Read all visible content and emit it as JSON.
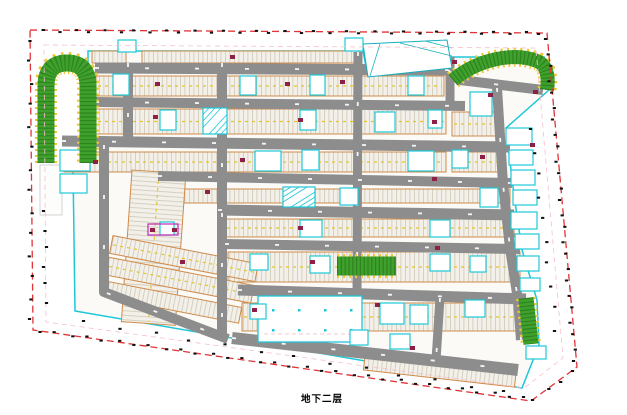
{
  "title": {
    "floor_label": "地下二层"
  },
  "colors": {
    "boundary_red": "#e03438",
    "inner_pink": "#f5bfcb",
    "cad_cyan": "#1ec7d8",
    "cad_teal": "#16b0bc",
    "road_gray": "#8d8d8d",
    "garage_fill": "#fbfaf7",
    "stall_fill": "#f2f0e8",
    "stall_line": "#c9c3b2",
    "row_border_orange": "#cf8a4a",
    "lane_yellow": "#e3c42c",
    "ramp_green": "#3ea12c",
    "ramp_hatch_green": "#2e7d1e",
    "ramp_tooth_yellow": "#edc832",
    "marker_maroon": "#8e1f45",
    "magenta": "#c028b8",
    "tick_black": "#111111",
    "label_black": "#000000"
  },
  "plan": {
    "canvas": [
      627,
      415
    ],
    "label_pos": [
      322,
      398
    ],
    "boundary_outer": [
      [
        30,
        30
      ],
      [
        547,
        33
      ],
      [
        577,
        367
      ],
      [
        531,
        401
      ],
      [
        33,
        330
      ]
    ],
    "boundary_inner": [
      [
        44,
        45
      ],
      [
        536,
        48
      ],
      [
        563,
        358
      ],
      [
        524,
        388
      ],
      [
        46,
        322
      ]
    ],
    "garage_outline": [
      [
        88,
        51
      ],
      [
        363,
        51
      ],
      [
        368,
        77
      ],
      [
        447,
        69
      ],
      [
        450,
        57
      ],
      [
        544,
        57
      ],
      [
        549,
        90
      ],
      [
        506,
        128
      ],
      [
        514,
        195
      ],
      [
        522,
        250
      ],
      [
        537,
        300
      ],
      [
        539,
        345
      ],
      [
        522,
        388
      ],
      [
        75,
        311
      ],
      [
        73,
        168
      ],
      [
        88,
        162
      ]
    ],
    "left_strip": [
      40,
      165,
      22,
      50
    ],
    "slope_area": {
      "points": [
        [
          363,
          44
        ],
        [
          447,
          40
        ],
        [
          452,
          68
        ],
        [
          368,
          77
        ]
      ],
      "lines": [
        [
          380,
          44,
          370,
          76
        ],
        [
          400,
          43,
          452,
          56
        ],
        [
          425,
          41,
          452,
          48
        ]
      ]
    },
    "parking_rows": [
      {
        "x": 142,
        "y": 51,
        "w": 216,
        "h": 12,
        "angle": 0,
        "cx": 0,
        "cy": 0,
        "orient": "h"
      },
      {
        "x": 92,
        "y": 51,
        "w": 34,
        "h": 12,
        "angle": 0,
        "cx": 0,
        "cy": 0,
        "orient": "h"
      },
      {
        "x": 96,
        "y": 76,
        "w": 348,
        "h": 20,
        "angle": 0,
        "cx": 0,
        "cy": 0,
        "orient": "h"
      },
      {
        "x": 96,
        "y": 109,
        "w": 350,
        "h": 25,
        "angle": 0,
        "cx": 0,
        "cy": 0,
        "orient": "h"
      },
      {
        "x": 452,
        "y": 112,
        "w": 50,
        "h": 24,
        "angle": 0,
        "cx": 0,
        "cy": 0,
        "orient": "h"
      },
      {
        "x": 64,
        "y": 152,
        "w": 382,
        "h": 20,
        "angle": 0,
        "cx": 0,
        "cy": 0,
        "orient": "h"
      },
      {
        "x": 452,
        "y": 152,
        "w": 52,
        "h": 20,
        "angle": 0,
        "cx": 0,
        "cy": 0,
        "orient": "h"
      },
      {
        "x": 160,
        "y": 189,
        "w": 350,
        "h": 14,
        "angle": 0,
        "cx": 0,
        "cy": 0,
        "orient": "h"
      },
      {
        "x": 218,
        "y": 219,
        "w": 296,
        "h": 18,
        "angle": 0,
        "cx": 0,
        "cy": 0,
        "orient": "h"
      },
      {
        "x": 228,
        "y": 252,
        "w": 292,
        "h": 30,
        "angle": 0,
        "cx": 0,
        "cy": 0,
        "orient": "h"
      },
      {
        "x": 242,
        "y": 303,
        "w": 282,
        "h": 28,
        "angle": 0,
        "cx": 0,
        "cy": 0,
        "orient": "h"
      },
      {
        "x": 132,
        "y": 170,
        "w": 54,
        "h": 152,
        "angle": 4,
        "cx": 132,
        "cy": 170,
        "orient": "v"
      },
      {
        "x": 112,
        "y": 234,
        "w": 148,
        "h": 18,
        "angle": 11,
        "cx": 104,
        "cy": 240,
        "orient": "h"
      },
      {
        "x": 112,
        "y": 256,
        "w": 148,
        "h": 18,
        "angle": 11,
        "cx": 104,
        "cy": 240,
        "orient": "h"
      },
      {
        "x": 116,
        "y": 280,
        "w": 136,
        "h": 16,
        "angle": 11,
        "cx": 104,
        "cy": 240,
        "orient": "h"
      },
      {
        "x": 365,
        "y": 356,
        "w": 152,
        "h": 14,
        "angle": 6.5,
        "cx": 365,
        "cy": 356,
        "orient": "h"
      }
    ],
    "roads": [
      {
        "pts": [
          [
            95,
            68
          ],
          [
            448,
            70
          ]
        ],
        "w": 11
      },
      {
        "pts": [
          [
            448,
            70
          ],
          [
            460,
            80
          ],
          [
            543,
            90
          ]
        ],
        "w": 10
      },
      {
        "pts": [
          [
            95,
            102
          ],
          [
            465,
            106
          ]
        ],
        "w": 10
      },
      {
        "pts": [
          [
            62,
            141
          ],
          [
            510,
            147
          ]
        ],
        "w": 11
      },
      {
        "pts": [
          [
            158,
            176
          ],
          [
            512,
            183
          ]
        ],
        "w": 10
      },
      {
        "pts": [
          [
            218,
            210
          ],
          [
            514,
            215
          ]
        ],
        "w": 11
      },
      {
        "pts": [
          [
            225,
            244
          ],
          [
            520,
            249
          ]
        ],
        "w": 10
      },
      {
        "pts": [
          [
            238,
            290
          ],
          [
            526,
            299
          ]
        ],
        "w": 11
      },
      {
        "pts": [
          [
            232,
            338
          ],
          [
            518,
            370
          ]
        ],
        "w": 12
      },
      {
        "pts": [
          [
            128,
            63
          ],
          [
            128,
            145
          ]
        ],
        "w": 10
      },
      {
        "pts": [
          [
            104,
            145
          ],
          [
            104,
            292
          ],
          [
            228,
            339
          ]
        ],
        "w": 10
      },
      {
        "pts": [
          [
            222,
            63
          ],
          [
            222,
            338
          ]
        ],
        "w": 10
      },
      {
        "pts": [
          [
            358,
            52
          ],
          [
            357,
            298
          ]
        ],
        "w": 9
      },
      {
        "pts": [
          [
            450,
            57
          ],
          [
            450,
            104
          ]
        ],
        "w": 9
      },
      {
        "pts": [
          [
            497,
            88
          ],
          [
            503,
            184
          ],
          [
            510,
            248
          ],
          [
            518,
            300
          ],
          [
            521,
            340
          ]
        ],
        "w": 10
      },
      {
        "pts": [
          [
            305,
            297
          ],
          [
            301,
            341
          ]
        ],
        "w": 9
      },
      {
        "pts": [
          [
            440,
            298
          ],
          [
            436,
            360
          ]
        ],
        "w": 9
      }
    ],
    "ramps": [
      {
        "path": "M46,163 L46,86 Q46,63 67,63 Q88,63 88,86 L88,163",
        "w": 17
      },
      {
        "path": "M453,80 C478,59 514,52 537,61 C547,65 549,77 547,90",
        "w": 14
      },
      {
        "path": "M526,298 L531,344",
        "w": 15
      },
      {
        "path": "M337,266 L396,266",
        "w": 19
      }
    ],
    "cores": [
      [
        118,
        40,
        18,
        12
      ],
      [
        345,
        38,
        18,
        13
      ],
      [
        113,
        74,
        16,
        21
      ],
      [
        240,
        76,
        16,
        19
      ],
      [
        310,
        75,
        15,
        20
      ],
      [
        408,
        76,
        16,
        19
      ],
      [
        160,
        110,
        16,
        20
      ],
      [
        300,
        110,
        16,
        20
      ],
      [
        375,
        112,
        20,
        20
      ],
      [
        428,
        110,
        14,
        18
      ],
      [
        470,
        92,
        22,
        24
      ],
      [
        60,
        150,
        30,
        21
      ],
      [
        60,
        174,
        27,
        19
      ],
      [
        255,
        151,
        26,
        20
      ],
      [
        302,
        150,
        17,
        20
      ],
      [
        408,
        151,
        26,
        20
      ],
      [
        452,
        150,
        16,
        18
      ],
      [
        340,
        188,
        18,
        17
      ],
      [
        480,
        188,
        18,
        19
      ],
      [
        300,
        220,
        22,
        17
      ],
      [
        430,
        220,
        20,
        17
      ],
      [
        160,
        222,
        14,
        13
      ],
      [
        250,
        254,
        18,
        16
      ],
      [
        310,
        256,
        20,
        17
      ],
      [
        430,
        254,
        20,
        17
      ],
      [
        470,
        256,
        16,
        16
      ],
      [
        380,
        303,
        24,
        21
      ],
      [
        410,
        305,
        18,
        19
      ],
      [
        250,
        304,
        16,
        15
      ],
      [
        465,
        300,
        20,
        17
      ],
      [
        350,
        330,
        18,
        15
      ],
      [
        390,
        334,
        20,
        15
      ],
      [
        506,
        128,
        26,
        17
      ],
      [
        509,
        150,
        24,
        15
      ],
      [
        511,
        170,
        24,
        15
      ],
      [
        513,
        190,
        24,
        15
      ],
      [
        511,
        212,
        26,
        17
      ],
      [
        515,
        234,
        24,
        15
      ],
      [
        517,
        256,
        22,
        15
      ],
      [
        520,
        278,
        20,
        13
      ],
      [
        526,
        346,
        20,
        13
      ]
    ],
    "hatch_cores": [
      [
        203,
        108,
        24,
        26
      ],
      [
        283,
        187,
        32,
        20
      ]
    ],
    "open_room": {
      "x": 258,
      "y": 296,
      "w": 104,
      "h": 46
    },
    "markers": [
      [
        155,
        82
      ],
      [
        230,
        55
      ],
      [
        285,
        82
      ],
      [
        340,
        80
      ],
      [
        452,
        60
      ],
      [
        488,
        93
      ],
      [
        153,
        115
      ],
      [
        298,
        118
      ],
      [
        432,
        120
      ],
      [
        530,
        143
      ],
      [
        93,
        160
      ],
      [
        240,
        158
      ],
      [
        432,
        177
      ],
      [
        480,
        155
      ],
      [
        150,
        228
      ],
      [
        172,
        228
      ],
      [
        298,
        226
      ],
      [
        435,
        246
      ],
      [
        180,
        260
      ],
      [
        310,
        260
      ],
      [
        252,
        308
      ],
      [
        410,
        346
      ],
      [
        533,
        90
      ],
      [
        375,
        303
      ],
      [
        205,
        190
      ]
    ],
    "magenta_box": [
      148,
      224,
      30,
      11
    ],
    "tick_edges": [
      {
        "from": [
          45,
          31
        ],
        "to": [
          540,
          33
        ],
        "count": 34
      },
      {
        "from": [
          547,
          40
        ],
        "to": [
          575,
          362
        ],
        "count": 25
      },
      {
        "from": [
          574,
          372
        ],
        "to": [
          534,
          399
        ],
        "count": 4
      },
      {
        "from": [
          525,
          398
        ],
        "to": [
          40,
          331
        ],
        "count": 32
      },
      {
        "from": [
          31,
          320
        ],
        "to": [
          30,
          40
        ],
        "count": 14
      },
      {
        "from": [
          532,
          130
        ],
        "to": [
          556,
          330
        ],
        "count": 10
      },
      {
        "from": [
          85,
          322
        ],
        "to": [
          505,
          392
        ],
        "count": 13
      },
      {
        "from": [
          45,
          212
        ],
        "to": [
          45,
          302
        ],
        "count": 6
      }
    ]
  }
}
